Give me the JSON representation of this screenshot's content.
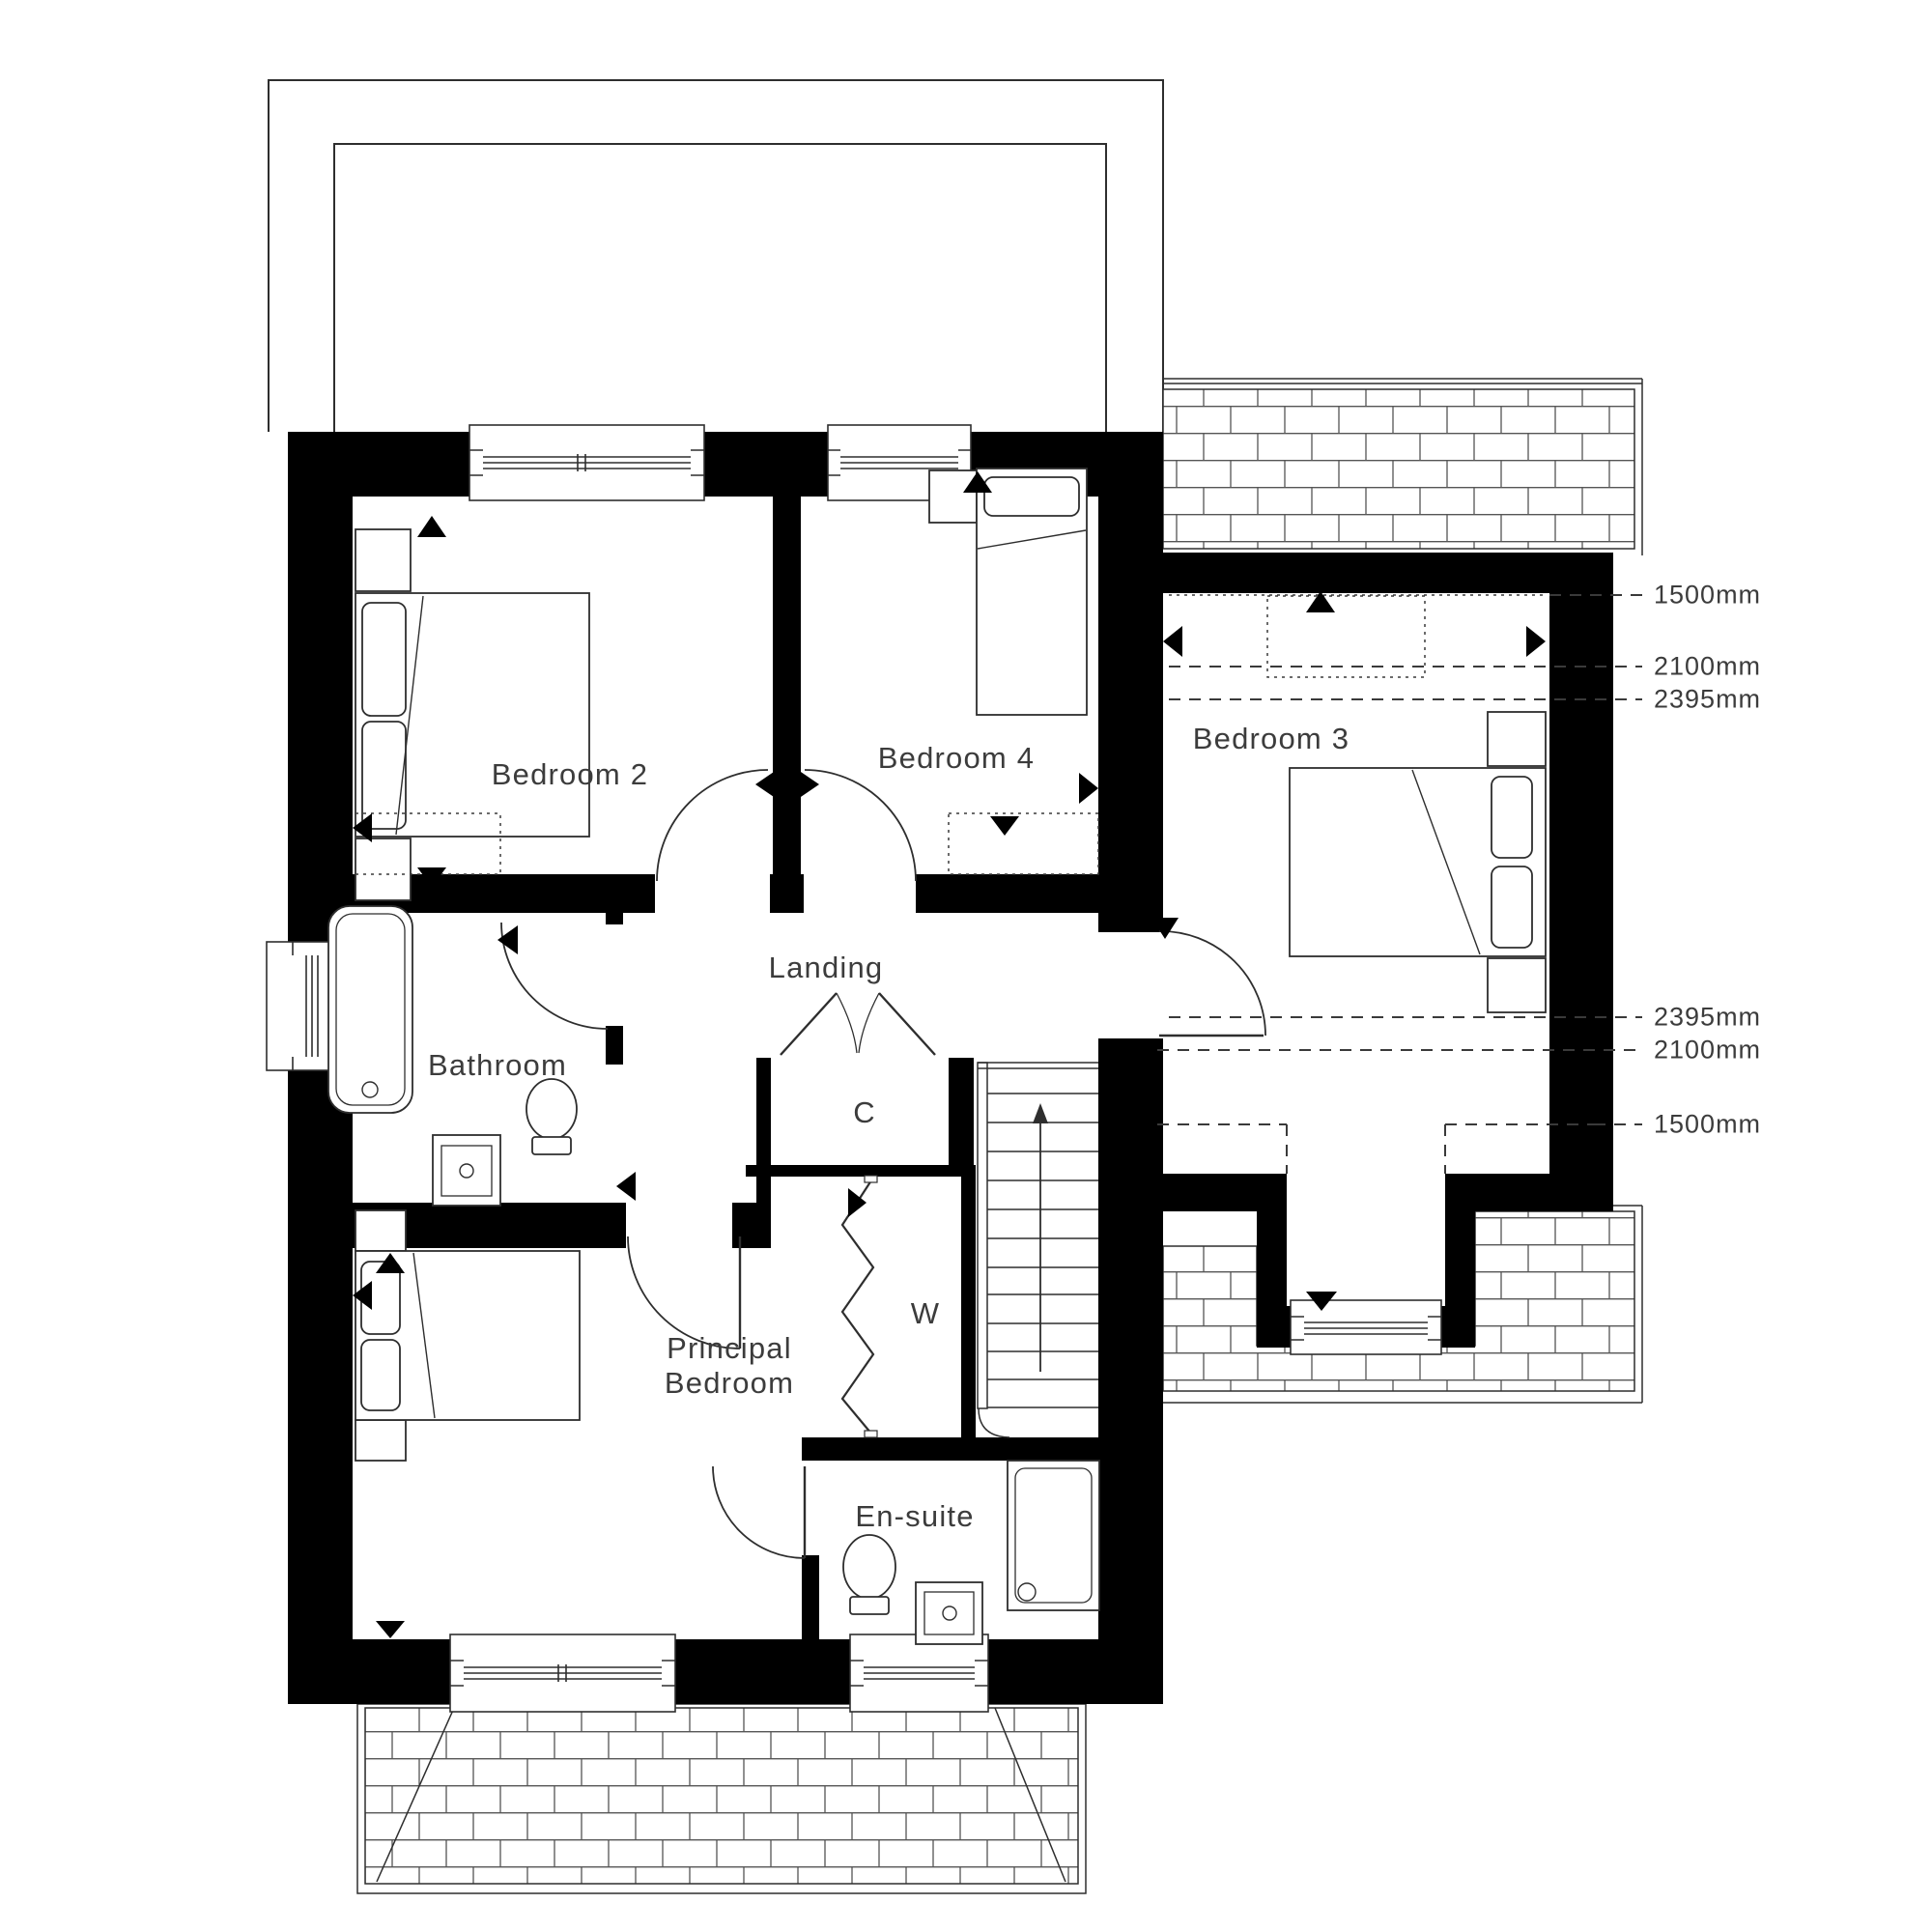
{
  "plan": {
    "title": "First floor plan",
    "rooms": {
      "bedroom2": {
        "label": "Bedroom 2"
      },
      "bedroom4": {
        "label": "Bedroom 4"
      },
      "bedroom3": {
        "label": "Bedroom 3"
      },
      "landing": {
        "label": "Landing"
      },
      "bathroom": {
        "label": "Bathroom"
      },
      "cupboard": {
        "label": "C"
      },
      "wardrobe": {
        "label": "W"
      },
      "principal": {
        "label_line1": "Principal",
        "label_line2": "Bedroom"
      },
      "ensuite": {
        "label": "En-suite"
      }
    },
    "dimensions": {
      "top": [
        {
          "label": "1500mm"
        },
        {
          "label": "2100mm"
        },
        {
          "label": "2395mm"
        }
      ],
      "bottom": [
        {
          "label": "2395mm"
        },
        {
          "label": "2100mm"
        },
        {
          "label": "1500mm"
        }
      ]
    },
    "colors": {
      "wall": "#000000",
      "line": "#2e2e2e",
      "text": "#3c3c3c",
      "background": "#ffffff"
    }
  }
}
